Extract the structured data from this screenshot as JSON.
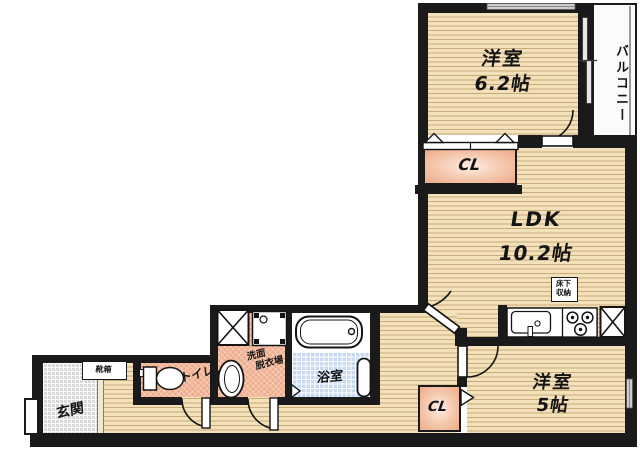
{
  "floorplan": {
    "bedroom_north": {
      "name": "洋室",
      "size": "6.2帖"
    },
    "balcony": {
      "label": "バルコニー"
    },
    "closet_north": {
      "label": "CL"
    },
    "ldk": {
      "name": "LDK",
      "size": "10.2帖"
    },
    "underfloor_storage": {
      "line1": "床下",
      "line2": "収納"
    },
    "bedroom_south": {
      "name": "洋室",
      "size": "5帖"
    },
    "closet_south": {
      "label": "CL"
    },
    "entrance": {
      "label": "玄関"
    },
    "shoe_cabinet": {
      "label": "靴箱"
    },
    "toilet": {
      "label": "トイレ"
    },
    "washroom": {
      "line1": "洗面",
      "line2": "脱衣場"
    },
    "bathroom": {
      "label": "浴室"
    },
    "colors": {
      "wall": "#1a1a1a",
      "flooring": "#f3e1bc",
      "flooring_line": "#c9ab77",
      "wet_floor": "#efae8d",
      "bath_tile": "#c7d9f1",
      "entrance_tile": "#d9d9d9",
      "closet_fill": "#f3c9b0"
    }
  }
}
